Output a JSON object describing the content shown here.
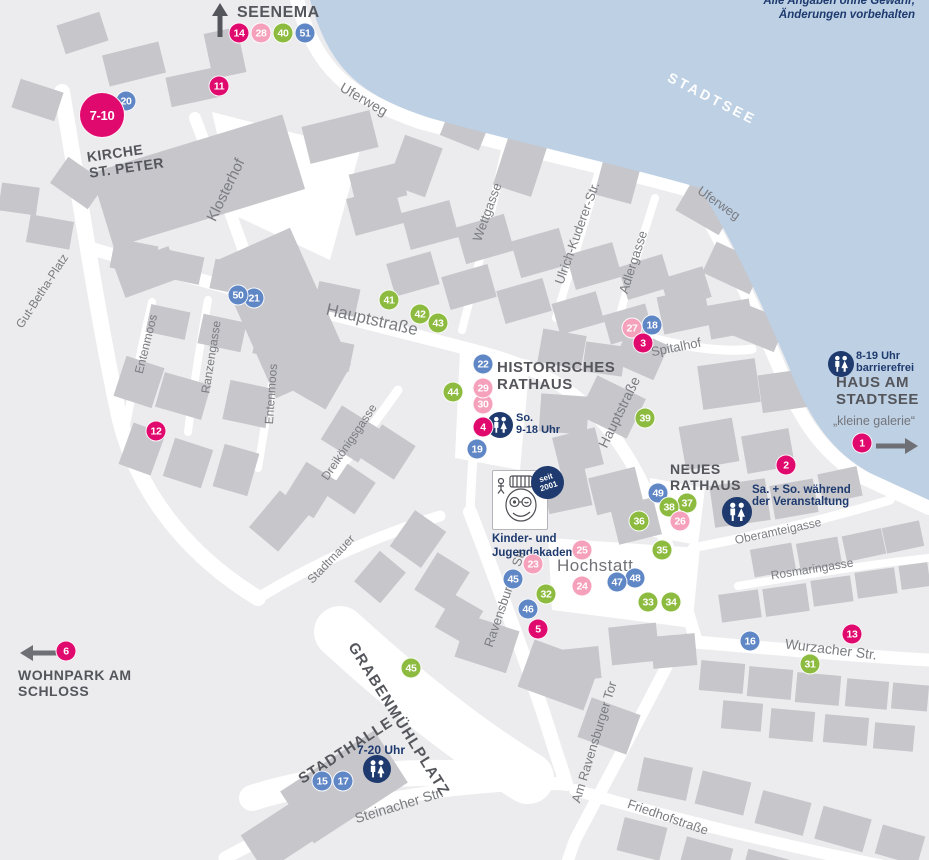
{
  "colors": {
    "magenta": "#e00a6e",
    "pink": "#f5a1bc",
    "green": "#8dbb3f",
    "blue": "#5f86c5",
    "navy": "#1e3a6e",
    "water": "#bdd0e4",
    "building": "#c6c6cb",
    "road": "#ffffff",
    "bg": "#ececee",
    "label_dark": "#55565c",
    "street_gray": "#7b7c81"
  },
  "disclaimer": {
    "line1": "Alle Angaben ohne Gewähr,",
    "line2": "Änderungen vorbehalten"
  },
  "logo": {
    "badge_line1": "seit",
    "badge_line2": "2001",
    "caption_line1": "Kinder- und",
    "caption_line2": "Jugendakademie"
  },
  "pois": [
    {
      "id": "seenema-label",
      "lines": [
        "SEENEMA"
      ],
      "x": 237,
      "y": 4,
      "fs": 16,
      "ls": 0.5
    },
    {
      "id": "kirche-st-peter-label",
      "lines": [
        "KIRCHE",
        "ST. PETER"
      ],
      "x": 86,
      "y": 150,
      "fs": 14,
      "rot": -8,
      "ls": 0.5
    },
    {
      "id": "historisches-rathaus-label",
      "lines": [
        "HISTORISCHES",
        "RATHAUS"
      ],
      "x": 497,
      "y": 360,
      "fs": 15,
      "ls": 0.5
    },
    {
      "id": "neues-rathaus-label",
      "lines": [
        "NEUES",
        "RATHAUS"
      ],
      "x": 670,
      "y": 462,
      "fs": 14,
      "ls": 0.5
    },
    {
      "id": "haus-am-stadtsee-label",
      "lines": [
        "HAUS AM",
        "STADTSEE"
      ],
      "x": 836,
      "y": 375,
      "fs": 15,
      "ls": 0.5
    },
    {
      "id": "wohnpark-am-schloss-label",
      "lines": [
        "WOHNPARK AM",
        "SCHLOSS"
      ],
      "x": 18,
      "y": 668,
      "fs": 14,
      "ls": 0.5
    },
    {
      "id": "stadthalle-label",
      "lines": [
        "STADTHALLE"
      ],
      "x": 296,
      "y": 774,
      "fs": 15,
      "rot": -33,
      "ls": 1
    },
    {
      "id": "grabenmuehlplatz-label",
      "lines": [
        "GRABENMÜHLPLATZ"
      ],
      "x": 358,
      "y": 640,
      "fs": 15,
      "rot": 58,
      "ls": 1.5
    },
    {
      "id": "hochstatt-label",
      "lines": [
        "Hochstatt"
      ],
      "x": 557,
      "y": 556,
      "fs": 17,
      "color": "#717277",
      "weight": "400",
      "ls": 0.5
    },
    {
      "id": "stadtsee-label",
      "lines": [
        "STADTSEE"
      ],
      "x": 672,
      "y": 70,
      "fs": 14,
      "rot": 27,
      "color": "#ffffff",
      "ls": 3
    }
  ],
  "streets": [
    {
      "name": "Uferweg",
      "x": 364,
      "y": 99,
      "rot": 30,
      "fs": 14
    },
    {
      "name": "Uferweg",
      "x": 719,
      "y": 203,
      "rot": 35,
      "fs": 13
    },
    {
      "name": "Klosterhof",
      "x": 226,
      "y": 190,
      "rot": -64,
      "fs": 15
    },
    {
      "name": "Wettgasse",
      "x": 487,
      "y": 212,
      "rot": -70,
      "fs": 13
    },
    {
      "name": "Ulrich-Kuderer-Str.",
      "x": 577,
      "y": 233,
      "rot": -70,
      "fs": 13
    },
    {
      "name": "Adlergasse",
      "x": 633,
      "y": 262,
      "rot": -72,
      "fs": 13
    },
    {
      "name": "Hauptstraße",
      "x": 372,
      "y": 320,
      "rot": 13,
      "fs": 17
    },
    {
      "name": "Hauptstraße",
      "x": 619,
      "y": 412,
      "rot": -64,
      "fs": 14
    },
    {
      "name": "Gut-Betha-Platz",
      "x": 42,
      "y": 291,
      "rot": -57,
      "fs": 12
    },
    {
      "name": "Ranzengasse",
      "x": 211,
      "y": 357,
      "rot": -81,
      "fs": 12
    },
    {
      "name": "Entenmoos",
      "x": 146,
      "y": 344,
      "rot": -76,
      "fs": 12
    },
    {
      "name": "Entenmoos",
      "x": 271,
      "y": 394,
      "rot": -86,
      "fs": 12
    },
    {
      "name": "Dreikönigsgasse",
      "x": 349,
      "y": 442,
      "rot": -56,
      "fs": 12
    },
    {
      "name": "Spitalhof",
      "x": 676,
      "y": 347,
      "rot": -11,
      "fs": 13
    },
    {
      "name": "Stadtmauer",
      "x": 331,
      "y": 559,
      "rot": -46,
      "fs": 12
    },
    {
      "name": "Ravensburger Str.",
      "x": 505,
      "y": 597,
      "rot": -71,
      "fs": 13
    },
    {
      "name": "Oberamteigasse",
      "x": 778,
      "y": 531,
      "rot": -12,
      "fs": 12
    },
    {
      "name": "Rosmaringasse",
      "x": 812,
      "y": 569,
      "rot": -9,
      "fs": 12
    },
    {
      "name": "Wurzacher Str.",
      "x": 831,
      "y": 649,
      "rot": 7,
      "fs": 14
    },
    {
      "name": "Am Ravensburger Tor",
      "x": 594,
      "y": 742,
      "rot": -73,
      "fs": 13
    },
    {
      "name": "Friedhofstraße",
      "x": 668,
      "y": 817,
      "rot": 19,
      "fs": 13
    },
    {
      "name": "Steinacher Str.",
      "x": 399,
      "y": 805,
      "rot": -17,
      "fs": 14
    }
  ],
  "markers": [
    {
      "n": "20",
      "color": "blue",
      "x": 126,
      "y": 101
    },
    {
      "n": "7-10",
      "color": "magenta",
      "x": 102,
      "y": 115,
      "d": 46
    },
    {
      "n": "11",
      "color": "magenta",
      "x": 219,
      "y": 86
    },
    {
      "n": "51",
      "color": "blue",
      "x": 305,
      "y": 33
    },
    {
      "n": "40",
      "color": "green",
      "x": 283,
      "y": 33
    },
    {
      "n": "28",
      "color": "pink",
      "x": 261,
      "y": 33
    },
    {
      "n": "14",
      "color": "magenta",
      "x": 239,
      "y": 33
    },
    {
      "n": "12",
      "color": "magenta",
      "x": 156,
      "y": 431
    },
    {
      "n": "21",
      "color": "blue",
      "x": 254,
      "y": 298
    },
    {
      "n": "50",
      "color": "blue",
      "x": 238,
      "y": 295
    },
    {
      "n": "41",
      "color": "green",
      "x": 389,
      "y": 300
    },
    {
      "n": "42",
      "color": "green",
      "x": 420,
      "y": 314
    },
    {
      "n": "43",
      "color": "green",
      "x": 438,
      "y": 323
    },
    {
      "n": "44",
      "color": "green",
      "x": 453,
      "y": 392
    },
    {
      "n": "22",
      "color": "blue",
      "x": 483,
      "y": 364
    },
    {
      "n": "30",
      "color": "pink",
      "x": 483,
      "y": 404
    },
    {
      "n": "29",
      "color": "pink",
      "x": 483,
      "y": 388
    },
    {
      "n": "4",
      "color": "magenta",
      "x": 483,
      "y": 427
    },
    {
      "n": "19",
      "color": "blue",
      "x": 477,
      "y": 449
    },
    {
      "n": "27",
      "color": "pink",
      "x": 632,
      "y": 328
    },
    {
      "n": "18",
      "color": "blue",
      "x": 652,
      "y": 325
    },
    {
      "n": "3",
      "color": "magenta",
      "x": 643,
      "y": 343
    },
    {
      "n": "39",
      "color": "green",
      "x": 645,
      "y": 418
    },
    {
      "n": "49",
      "color": "blue",
      "x": 658,
      "y": 493
    },
    {
      "n": "37",
      "color": "green",
      "x": 687,
      "y": 503
    },
    {
      "n": "38",
      "color": "green",
      "x": 669,
      "y": 507
    },
    {
      "n": "26",
      "color": "pink",
      "x": 680,
      "y": 521
    },
    {
      "n": "36",
      "color": "green",
      "x": 639,
      "y": 521
    },
    {
      "n": "35",
      "color": "green",
      "x": 662,
      "y": 550
    },
    {
      "n": "25",
      "color": "pink",
      "x": 582,
      "y": 550
    },
    {
      "n": "23",
      "color": "pink",
      "x": 533,
      "y": 564
    },
    {
      "n": "24",
      "color": "pink",
      "x": 582,
      "y": 586
    },
    {
      "n": "45",
      "color": "blue",
      "x": 513,
      "y": 579
    },
    {
      "n": "32",
      "color": "green",
      "x": 546,
      "y": 594
    },
    {
      "n": "46",
      "color": "blue",
      "x": 528,
      "y": 609
    },
    {
      "n": "5",
      "color": "magenta",
      "x": 538,
      "y": 629
    },
    {
      "n": "48",
      "color": "blue",
      "x": 635,
      "y": 578
    },
    {
      "n": "47",
      "color": "blue",
      "x": 617,
      "y": 582
    },
    {
      "n": "33",
      "color": "green",
      "x": 648,
      "y": 602
    },
    {
      "n": "34",
      "color": "green",
      "x": 671,
      "y": 602
    },
    {
      "n": "2",
      "color": "magenta",
      "x": 786,
      "y": 465
    },
    {
      "n": "1",
      "color": "magenta",
      "x": 862,
      "y": 443
    },
    {
      "n": "16",
      "color": "blue",
      "x": 750,
      "y": 641
    },
    {
      "n": "13",
      "color": "magenta",
      "x": 852,
      "y": 634
    },
    {
      "n": "31",
      "color": "green",
      "x": 810,
      "y": 664
    },
    {
      "n": "45",
      "color": "green",
      "x": 411,
      "y": 668
    },
    {
      "n": "6",
      "color": "magenta",
      "x": 66,
      "y": 651
    },
    {
      "n": "15",
      "color": "blue",
      "x": 322,
      "y": 781
    },
    {
      "n": "17",
      "color": "blue",
      "x": 343,
      "y": 781
    }
  ],
  "wc_icons": [
    {
      "id": "wc-historisches-rathaus",
      "x": 500,
      "y": 425,
      "d": 26
    },
    {
      "id": "wc-neues-rathaus",
      "x": 737,
      "y": 512,
      "d": 30
    },
    {
      "id": "wc-haus-am-stadtsee",
      "x": 841,
      "y": 364,
      "d": 26
    },
    {
      "id": "wc-stadthalle",
      "x": 377,
      "y": 769,
      "d": 28
    }
  ],
  "notes": [
    {
      "id": "hours-historisches-rathaus",
      "lines": [
        "So.",
        "9-18 Uhr"
      ],
      "x": 516,
      "y": 413,
      "fs": 11
    },
    {
      "id": "hours-neues-rathaus",
      "lines": [
        "Sa. + So. während",
        "der Veranstaltung"
      ],
      "x": 752,
      "y": 484,
      "fs": 11.5
    },
    {
      "id": "hours-haus-am-stadtsee",
      "lines": [
        "8-19 Uhr",
        "barrierefrei"
      ],
      "x": 856,
      "y": 351,
      "fs": 11
    },
    {
      "id": "hours-stadthalle",
      "lines": [
        "7-20 Uhr"
      ],
      "x": 357,
      "y": 744,
      "fs": 12
    },
    {
      "id": "kleine-galerie-label",
      "lines": [
        "„kleine galerie“"
      ],
      "x": 833,
      "y": 415,
      "fs": 12.5,
      "color": "#74757a",
      "weight": "400"
    }
  ],
  "arrows": [
    {
      "id": "seenema-direction-arrow",
      "dir": "up",
      "x": 207,
      "y": 3,
      "len": 36,
      "color": "#55565c"
    },
    {
      "id": "wohnpark-direction-arrow",
      "dir": "left",
      "x": 20,
      "y": 640,
      "len": 42,
      "color": "#6f7075"
    },
    {
      "id": "haus-am-stadtsee-direction-arrow",
      "dir": "right",
      "x": 874,
      "y": 433,
      "len": 44,
      "color": "#6f7075"
    }
  ]
}
